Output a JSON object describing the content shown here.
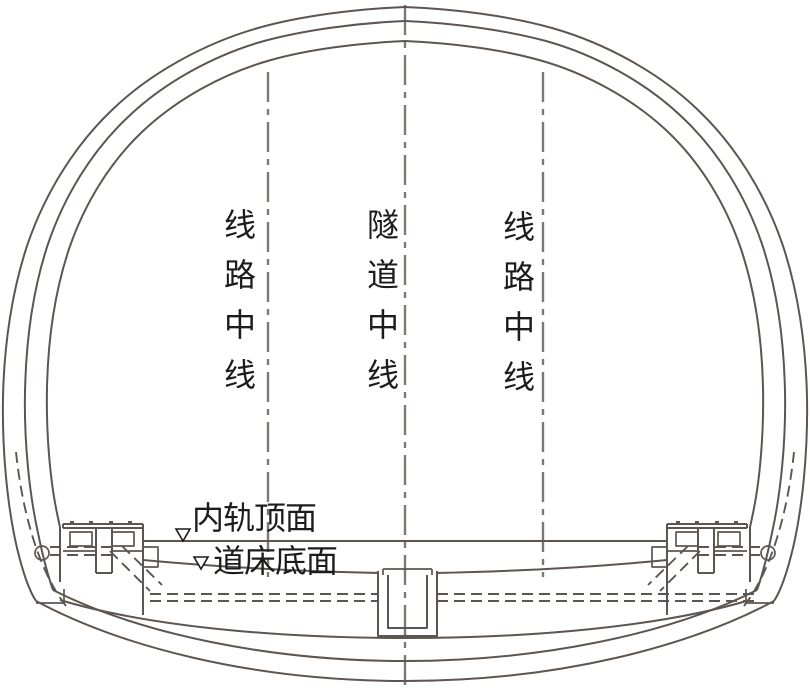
{
  "diagram": {
    "name": "railway-tunnel-cross-section",
    "labels": {
      "left_line_centerline": "线路中线",
      "tunnel_centerline": "隧道中线",
      "right_line_centerline": "线路中线",
      "rail_top_surface": "内轨顶面",
      "bed_bottom_surface": "道床底面"
    },
    "markers": {
      "rail_top_marker": "open-triangle-down",
      "bed_bottom_marker": "open-triangle-down"
    },
    "colors": {
      "line": "#5d5650",
      "centerline": "#7e7872",
      "text": "#1c1c1c",
      "background": "#ffffff"
    }
  }
}
